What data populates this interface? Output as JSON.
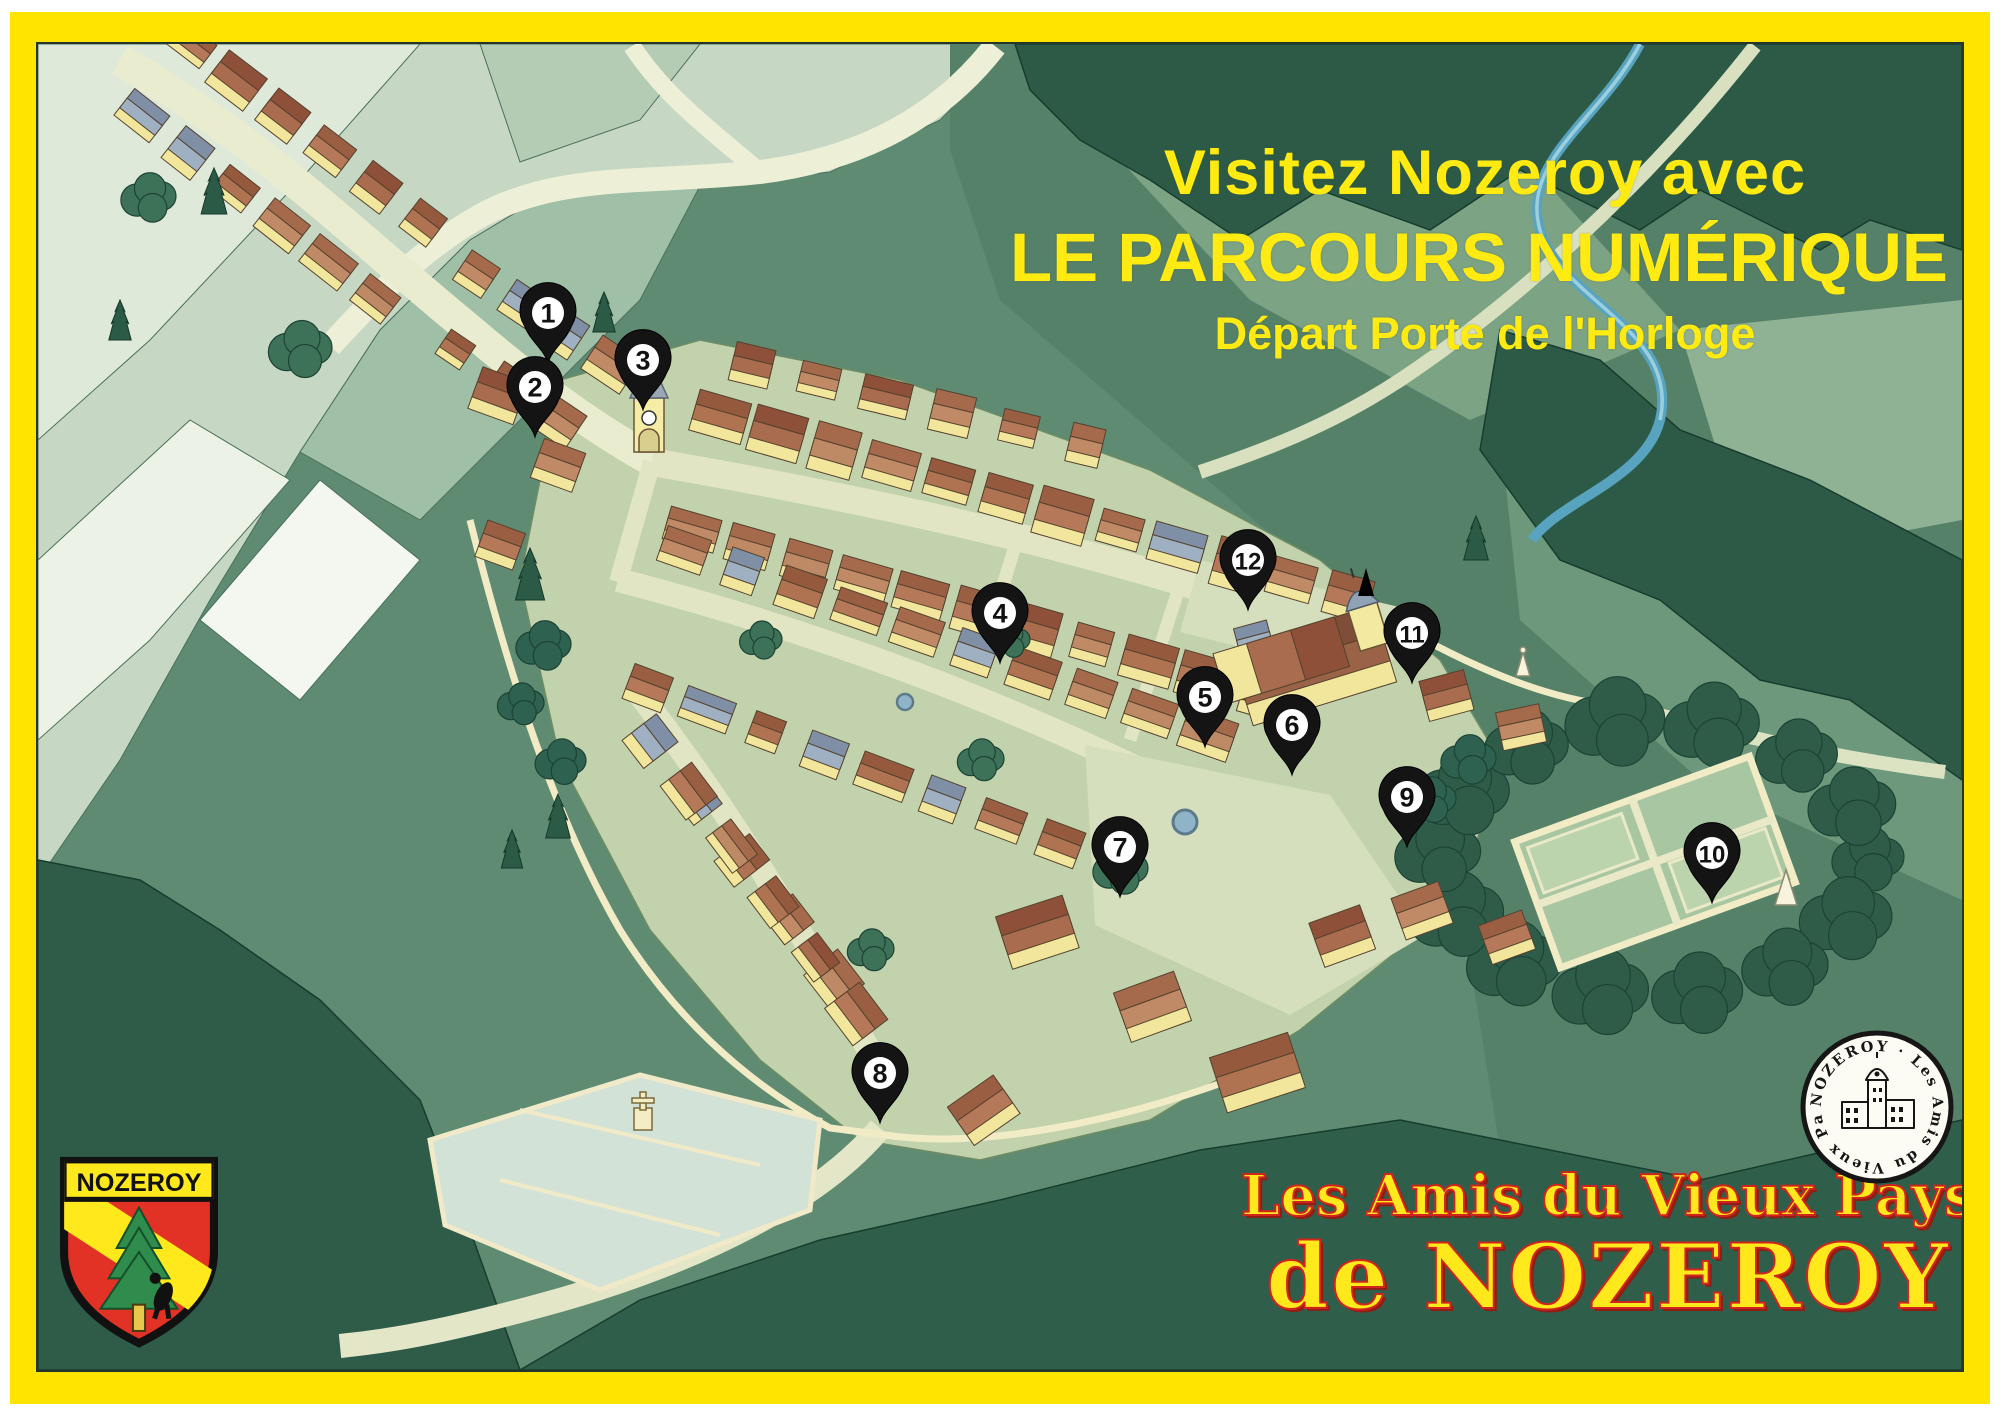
{
  "title": {
    "line1": "Visitez Nozeroy avec",
    "line2": "LE PARCOURS NUMÉRIQUE !",
    "line3": "Départ Porte de l'Horloge"
  },
  "association": {
    "line1": "Les Amis du Vieux Pays",
    "line2": "de NOZEROY"
  },
  "shield": {
    "label": "NOZEROY",
    "field_color": "#E23226",
    "band_color": "#FFE81C",
    "tree_color": "#2F8C4D"
  },
  "seal": {
    "text": "NOZEROY · Les Amis du Vieux Pays de"
  },
  "pins": [
    {
      "n": "1",
      "x": 548,
      "y": 363
    },
    {
      "n": "2",
      "x": 535,
      "y": 437
    },
    {
      "n": "3",
      "x": 643,
      "y": 410
    },
    {
      "n": "4",
      "x": 1000,
      "y": 663
    },
    {
      "n": "5",
      "x": 1205,
      "y": 747
    },
    {
      "n": "6",
      "x": 1292,
      "y": 775
    },
    {
      "n": "7",
      "x": 1120,
      "y": 897
    },
    {
      "n": "8",
      "x": 880,
      "y": 1123
    },
    {
      "n": "9",
      "x": 1407,
      "y": 847
    },
    {
      "n": "10",
      "x": 1712,
      "y": 903
    },
    {
      "n": "11",
      "x": 1412,
      "y": 683
    },
    {
      "n": "12",
      "x": 1248,
      "y": 610
    }
  ],
  "colors": {
    "frame": "#FFE400",
    "title_text": "#FFEA12",
    "association_fill": "#FFE81C",
    "association_outline": "#D2231C",
    "pin_fill": "#141414",
    "pin_disc": "#FFFFFF",
    "pin_number": "#111111"
  }
}
